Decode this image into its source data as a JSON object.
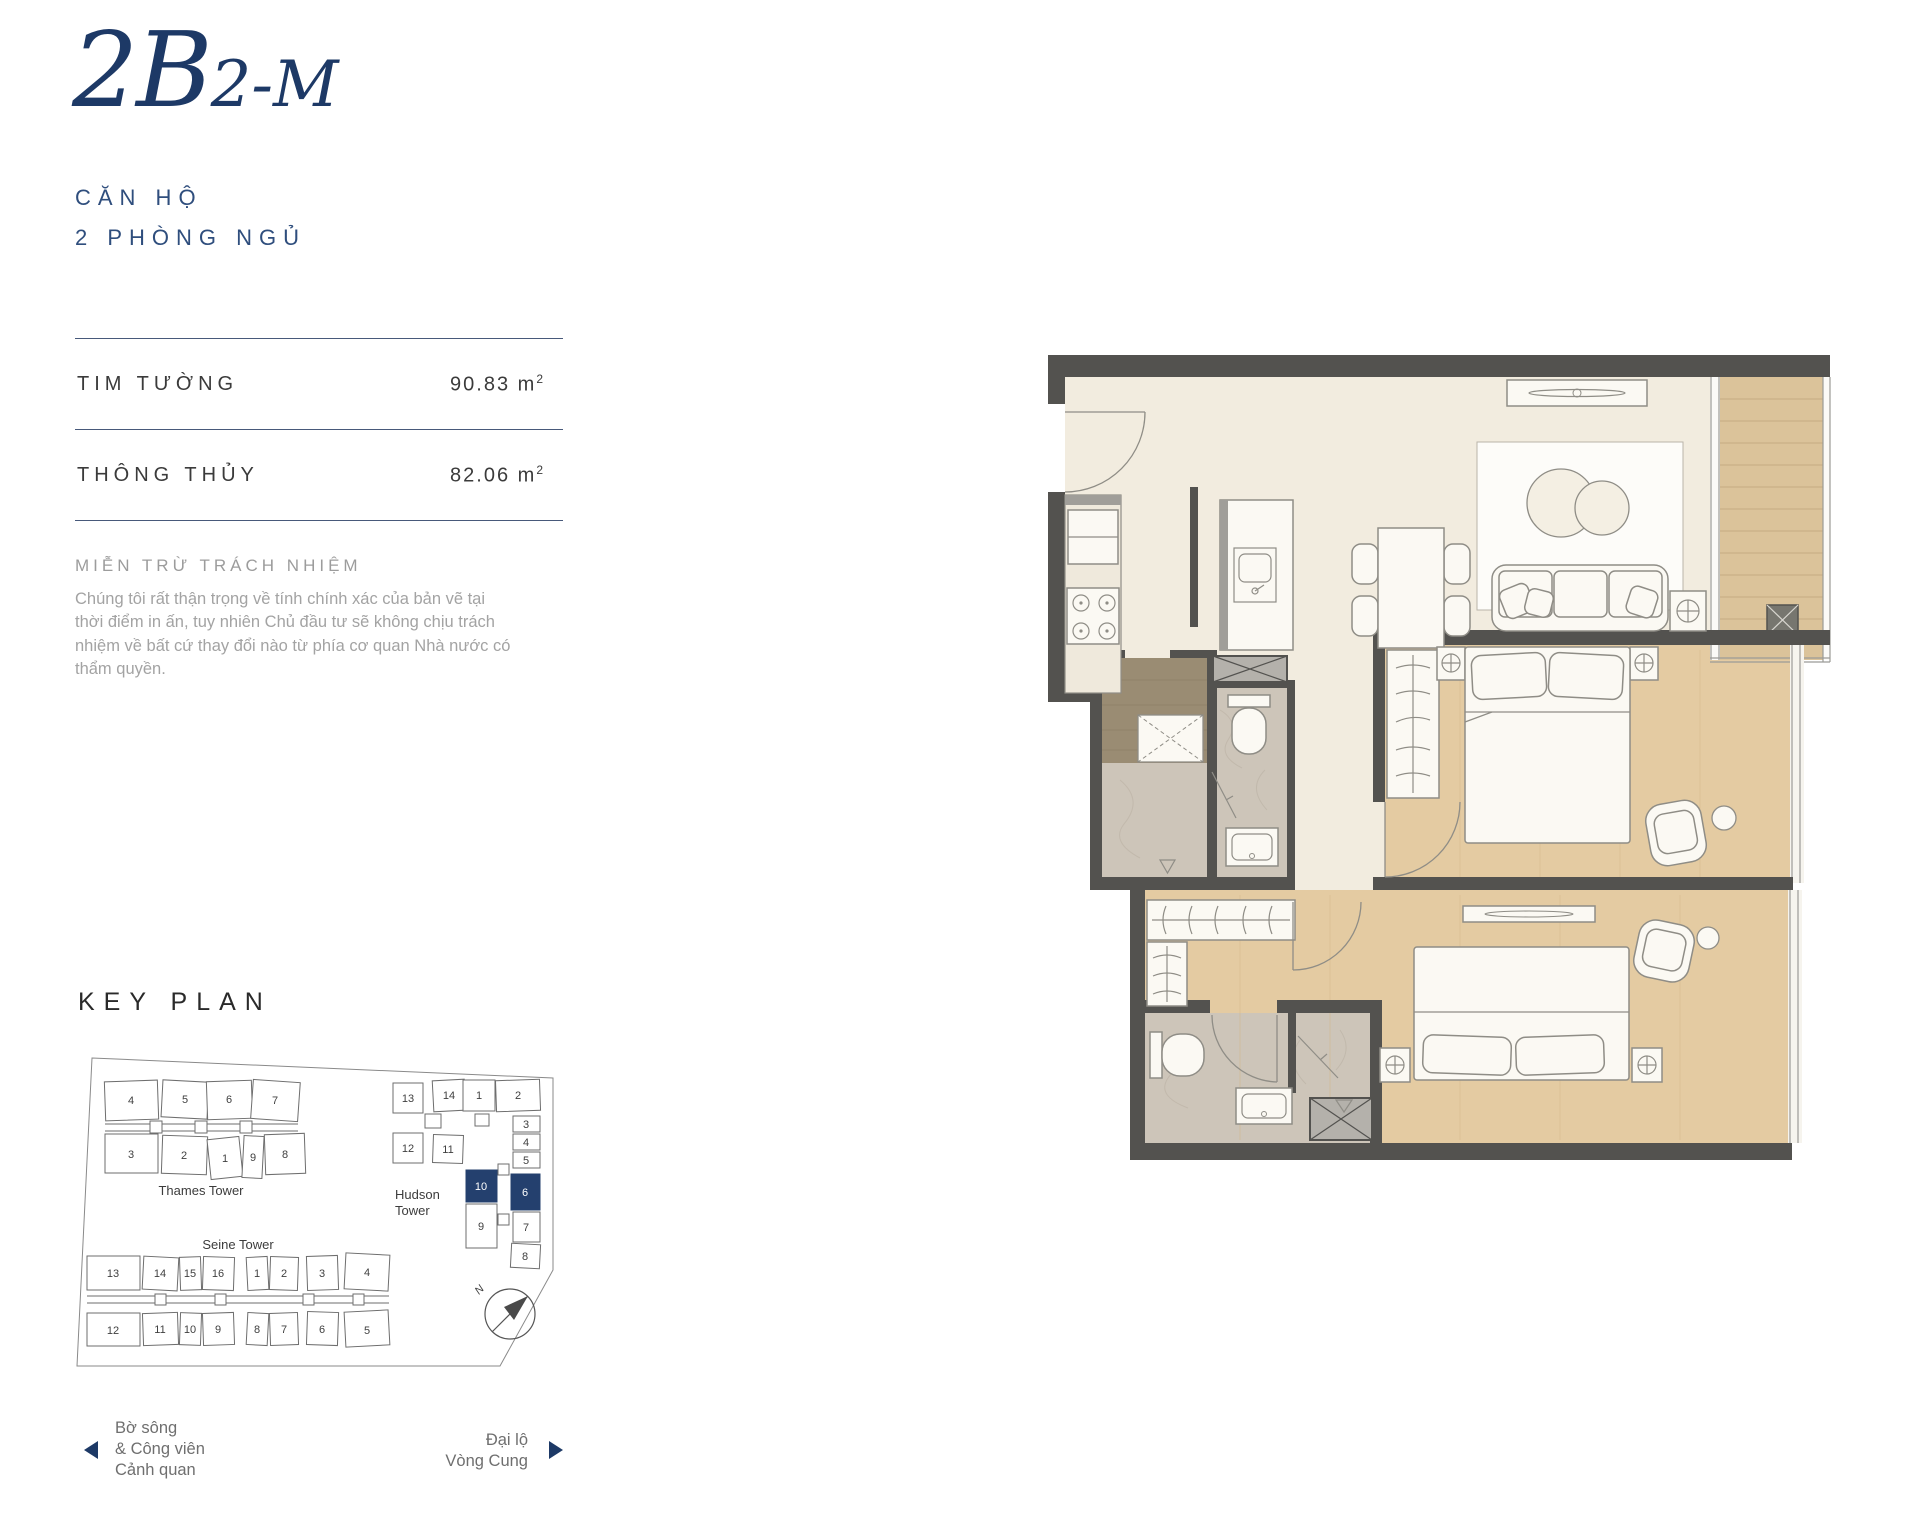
{
  "header": {
    "unit_code_main": "2B",
    "unit_code_sub": "2-M",
    "subtitle_line1": "CĂN HỘ",
    "subtitle_line2": "2 PHÒNG NGỦ"
  },
  "areas": {
    "rows": [
      {
        "label": "TIM TƯỜNG",
        "value": "90.83 m",
        "sup": "2"
      },
      {
        "label": "THÔNG THỦY",
        "value": "82.06 m",
        "sup": "2"
      }
    ]
  },
  "disclaimer": {
    "heading": "MIỄN TRỪ TRÁCH NHIỆM",
    "body": "Chúng tôi rất thận trọng về tính chính xác của bản vẽ tại thời điểm in ấn, tuy nhiên Chủ đầu tư sẽ không chịu trách nhiệm về bất cứ thay đổi nào từ phía cơ quan Nhà nước có thẩm quyền."
  },
  "keyplan": {
    "title": "KEY PLAN",
    "compass_label": "N",
    "highlighted_units": [
      "10",
      "6"
    ],
    "highlight_color": "#24406e",
    "towers": {
      "thames": {
        "name": "Thames Tower",
        "top_row": [
          "4",
          "5",
          "6",
          "7"
        ],
        "bottom_row": [
          "3",
          "2",
          "1",
          "9",
          "8"
        ]
      },
      "hudson": {
        "name_line1": "Hudson",
        "name_line2": "Tower",
        "left_top": [
          "13",
          "14"
        ],
        "left_bottom": [
          "12",
          "11"
        ],
        "top_row": [
          "1",
          "2"
        ],
        "right_col": [
          "3",
          "4",
          "5",
          "6",
          "7",
          "8"
        ],
        "mid_col": [
          "10",
          "9"
        ]
      },
      "seine": {
        "name": "Seine Tower",
        "top_row": [
          "13",
          "14",
          "15",
          "16",
          "1",
          "2",
          "3",
          "4"
        ],
        "bottom_row": [
          "12",
          "11",
          "10",
          "9",
          "8",
          "7",
          "6",
          "5"
        ]
      }
    }
  },
  "footer": {
    "left_lines": [
      "Bờ sông",
      "& Công viên",
      "Cảnh quan"
    ],
    "right_lines": [
      "Đại lộ",
      "Vòng Cung"
    ]
  },
  "colors": {
    "accent_navy": "#1d3966",
    "highlight_navy": "#24406e",
    "wall": "#53524f",
    "floor_cream": "#f2ecdf",
    "floor_wood": "#e4cba2",
    "floor_marble": "#cdc5b9"
  }
}
